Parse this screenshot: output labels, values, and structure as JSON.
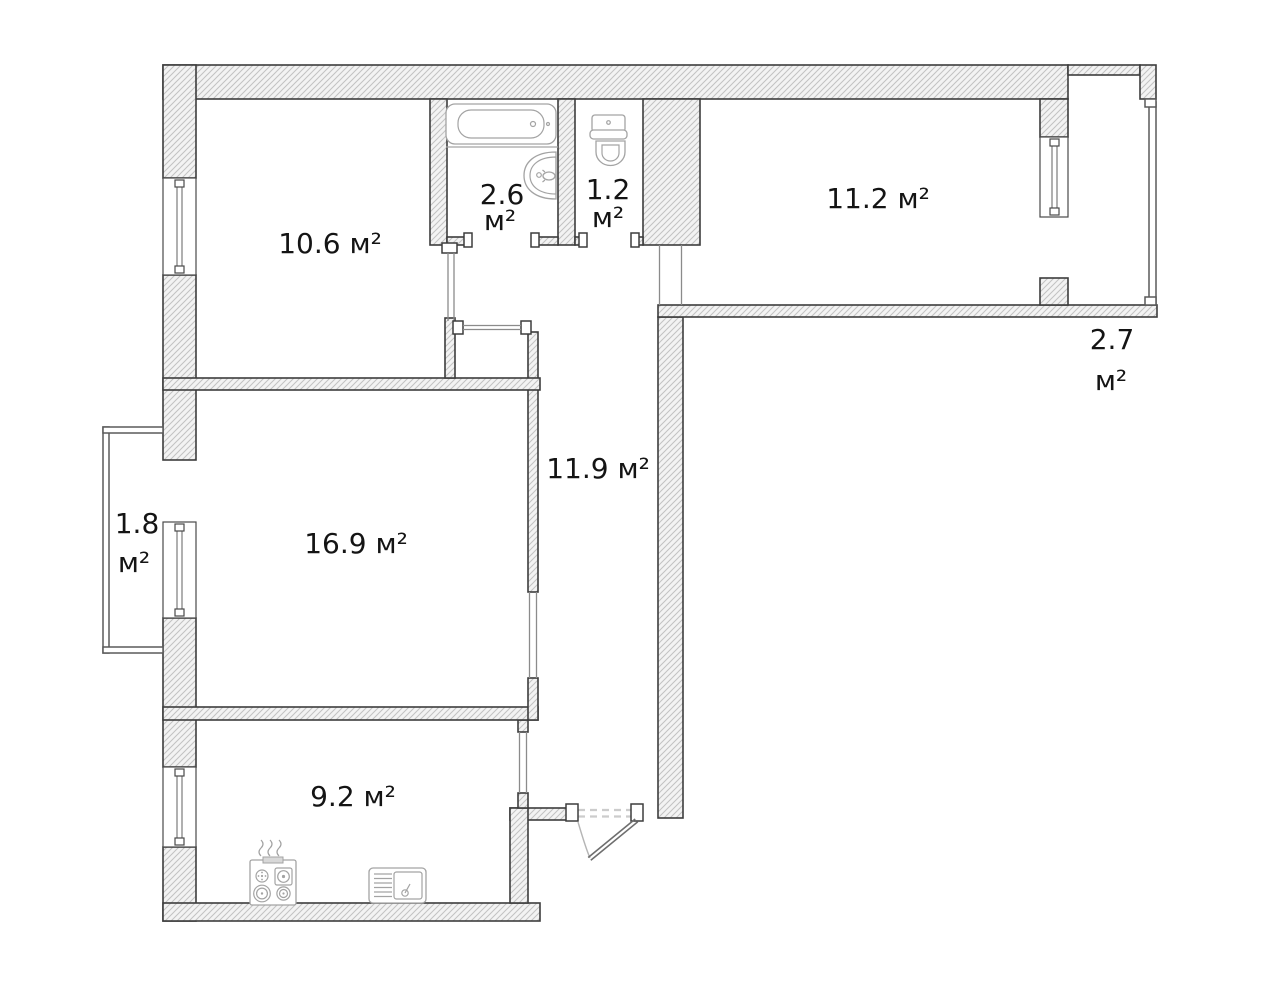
{
  "plan": {
    "title": "Apartment floor plan",
    "area_unit": "м²",
    "rooms": [
      {
        "name": "room-top-left",
        "area": "10.6",
        "label_line1": "10.6 м²",
        "label_line2": ""
      },
      {
        "name": "bathroom",
        "area": "2.6",
        "label_line1": "2.6",
        "label_line2": "м²"
      },
      {
        "name": "toilet",
        "area": "1.2",
        "label_line1": "1.2",
        "label_line2": "м²"
      },
      {
        "name": "room-top-right",
        "area": "11.2",
        "label_line1": "11.2 м²",
        "label_line2": ""
      },
      {
        "name": "balcony-right",
        "area": "2.7",
        "label_line1": "2.7",
        "label_line2": "м²"
      },
      {
        "name": "hallway",
        "area": "11.9",
        "label_line1": "11.9 м²",
        "label_line2": ""
      },
      {
        "name": "living-room",
        "area": "16.9",
        "label_line1": "16.9 м²",
        "label_line2": ""
      },
      {
        "name": "balcony-left",
        "area": "1.8",
        "label_line1": "1.8",
        "label_line2": "м²"
      },
      {
        "name": "kitchen",
        "area": "9.2",
        "label_line1": "9.2 м²",
        "label_line2": ""
      }
    ],
    "fixtures": [
      {
        "icon": "bathtub-icon",
        "room": "bathroom"
      },
      {
        "icon": "washbasin-icon",
        "room": "bathroom"
      },
      {
        "icon": "toilet-icon",
        "room": "toilet"
      },
      {
        "icon": "stove-icon",
        "room": "kitchen"
      },
      {
        "icon": "kitchen-sink-icon",
        "room": "kitchen"
      }
    ],
    "colors": {
      "wall_outline": "#3d3d3d",
      "hatch_line": "#c2c2c2",
      "fixture_line": "#a3a3a3",
      "label_text": "#141414",
      "background": "#ffffff"
    }
  }
}
